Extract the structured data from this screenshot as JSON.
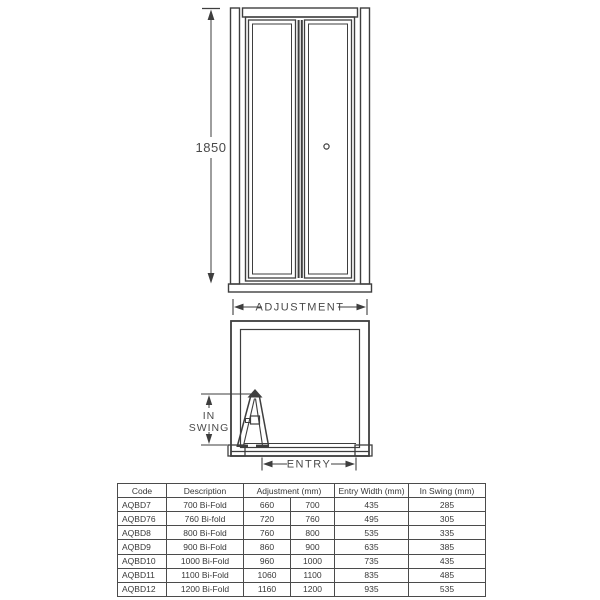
{
  "diagram": {
    "front_view": {
      "height_label": "1850",
      "adjustment_label": "ADJUSTMENT"
    },
    "plan_view": {
      "in_swing_label_line1": "IN",
      "in_swing_label_line2": "SWING",
      "entry_label": "ENTRY"
    },
    "colors": {
      "line": "#3e3e3e",
      "label_text": "#4a4a4a",
      "table_border": "#4b4b4b",
      "table_text": "#383838",
      "background": "#ffffff"
    }
  },
  "table": {
    "headers": {
      "code": "Code",
      "description": "Description",
      "adjustment": "Adjustment (mm)",
      "entry_width": "Entry Width (mm)",
      "in_swing": "In Swing (mm)"
    },
    "rows": [
      {
        "code": "AQBD7",
        "description": "700 Bi-Fold",
        "adjustment_min": "660",
        "adjustment_max": "700",
        "entry_width": "435",
        "in_swing": "285"
      },
      {
        "code": "AQBD76",
        "description": "760 Bi-fold",
        "adjustment_min": "720",
        "adjustment_max": "760",
        "entry_width": "495",
        "in_swing": "305"
      },
      {
        "code": "AQBD8",
        "description": "800 Bi-Fold",
        "adjustment_min": "760",
        "adjustment_max": "800",
        "entry_width": "535",
        "in_swing": "335"
      },
      {
        "code": "AQBD9",
        "description": "900 Bi-Fold",
        "adjustment_min": "860",
        "adjustment_max": "900",
        "entry_width": "635",
        "in_swing": "385"
      },
      {
        "code": "AQBD10",
        "description": "1000 Bi-Fold",
        "adjustment_min": "960",
        "adjustment_max": "1000",
        "entry_width": "735",
        "in_swing": "435"
      },
      {
        "code": "AQBD11",
        "description": "1100 Bi-Fold",
        "adjustment_min": "1060",
        "adjustment_max": "1100",
        "entry_width": "835",
        "in_swing": "485"
      },
      {
        "code": "AQBD12",
        "description": "1200 Bi-Fold",
        "adjustment_min": "1160",
        "adjustment_max": "1200",
        "entry_width": "935",
        "in_swing": "535"
      }
    ]
  }
}
